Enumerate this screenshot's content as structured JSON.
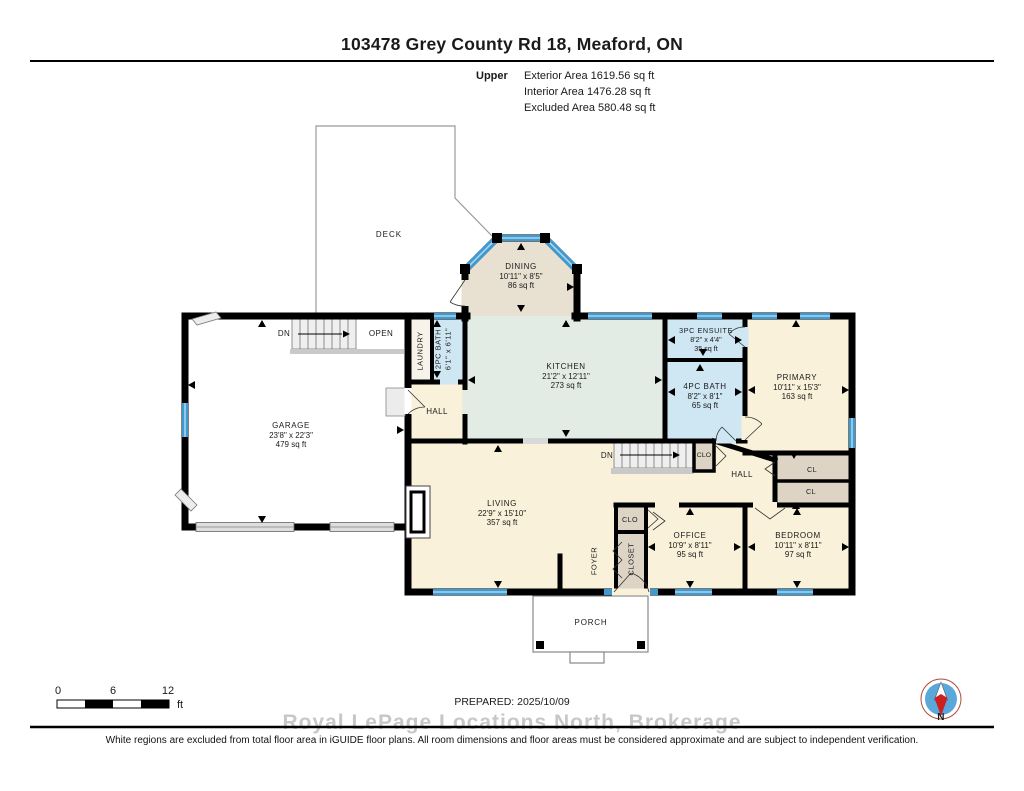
{
  "colors": {
    "wall": "#000000",
    "win-blue": "#3f9ad2",
    "win-lite": "#a6d6ef",
    "cream": "#f9f1da",
    "green": "#e3ece4",
    "blue": "#cfe6f3",
    "beige": "#e8e0d1",
    "closet": "#ddd4c6",
    "stair": "#efefef",
    "land": "#c9c9c9",
    "door-gray": "#dedede"
  },
  "header": {
    "title": "103478 Grey County Rd 18, Meaford, ON",
    "floor_label": "Upper",
    "exterior": "Exterior Area 1619.56 sq ft",
    "interior": "Interior Area 1476.28 sq ft",
    "excluded": "Excluded Area 580.48 sq ft"
  },
  "rooms": {
    "deck": {
      "name": "DECK"
    },
    "porch": {
      "name": "PORCH"
    },
    "dining": {
      "name": "DINING",
      "dims": "10'11\" x 8'5\"",
      "area": "86 sq ft"
    },
    "kitchen": {
      "name": "KITCHEN",
      "dims": "21'2\" x 12'11\"",
      "area": "273 sq ft"
    },
    "garage": {
      "name": "GARAGE",
      "dims": "23'8\" x 22'3\"",
      "area": "479 sq ft"
    },
    "living": {
      "name": "LIVING",
      "dims": "22'9\" x 15'10\"",
      "area": "357 sq ft"
    },
    "primary": {
      "name": "PRIMARY",
      "dims": "10'11\" x 15'3\"",
      "area": "163 sq ft"
    },
    "ensuite": {
      "name": "3PC ENSUITE",
      "dims": "8'2\" x 4'4\"",
      "area": "35 sq ft"
    },
    "bath4": {
      "name": "4PC BATH",
      "dims": "8'2\" x 8'1\"",
      "area": "65 sq ft"
    },
    "bath2": {
      "name": "2PC BATH",
      "dims": "6'1\" x 6'11\""
    },
    "office": {
      "name": "OFFICE",
      "dims": "10'9\" x 8'11\"",
      "area": "95 sq ft"
    },
    "bedroom": {
      "name": "BEDROOM",
      "dims": "10'11\" x 8'11\"",
      "area": "97 sq ft"
    },
    "laundry": {
      "name": "LAUNDRY"
    },
    "foyer": {
      "name": "FOYER"
    },
    "closet": {
      "name": "CLOSET"
    },
    "hall_main": {
      "name": "HALL"
    },
    "hall_bed": {
      "name": "HALL"
    },
    "clo_hall": {
      "name": "CLO"
    },
    "clo_foyer": {
      "name": "CLO"
    },
    "cl_a": {
      "name": "CL"
    },
    "cl_b": {
      "name": "CL"
    }
  },
  "plan_labels": {
    "dn_upper": "DN",
    "open": "OPEN",
    "dn_lower": "DN"
  },
  "scale_bar": {
    "t0": "0",
    "t6": "6",
    "t12": "12",
    "unit": "ft"
  },
  "footer": {
    "prepared": "PREPARED: 2025/10/09",
    "watermark": "Royal LePage Locations North, Brokerage",
    "disclaimer": "White regions are excluded from total floor area in iGUIDE floor plans. All room dimensions and floor areas must be considered approximate and are subject to independent verification."
  },
  "compass": {
    "north": "N"
  }
}
